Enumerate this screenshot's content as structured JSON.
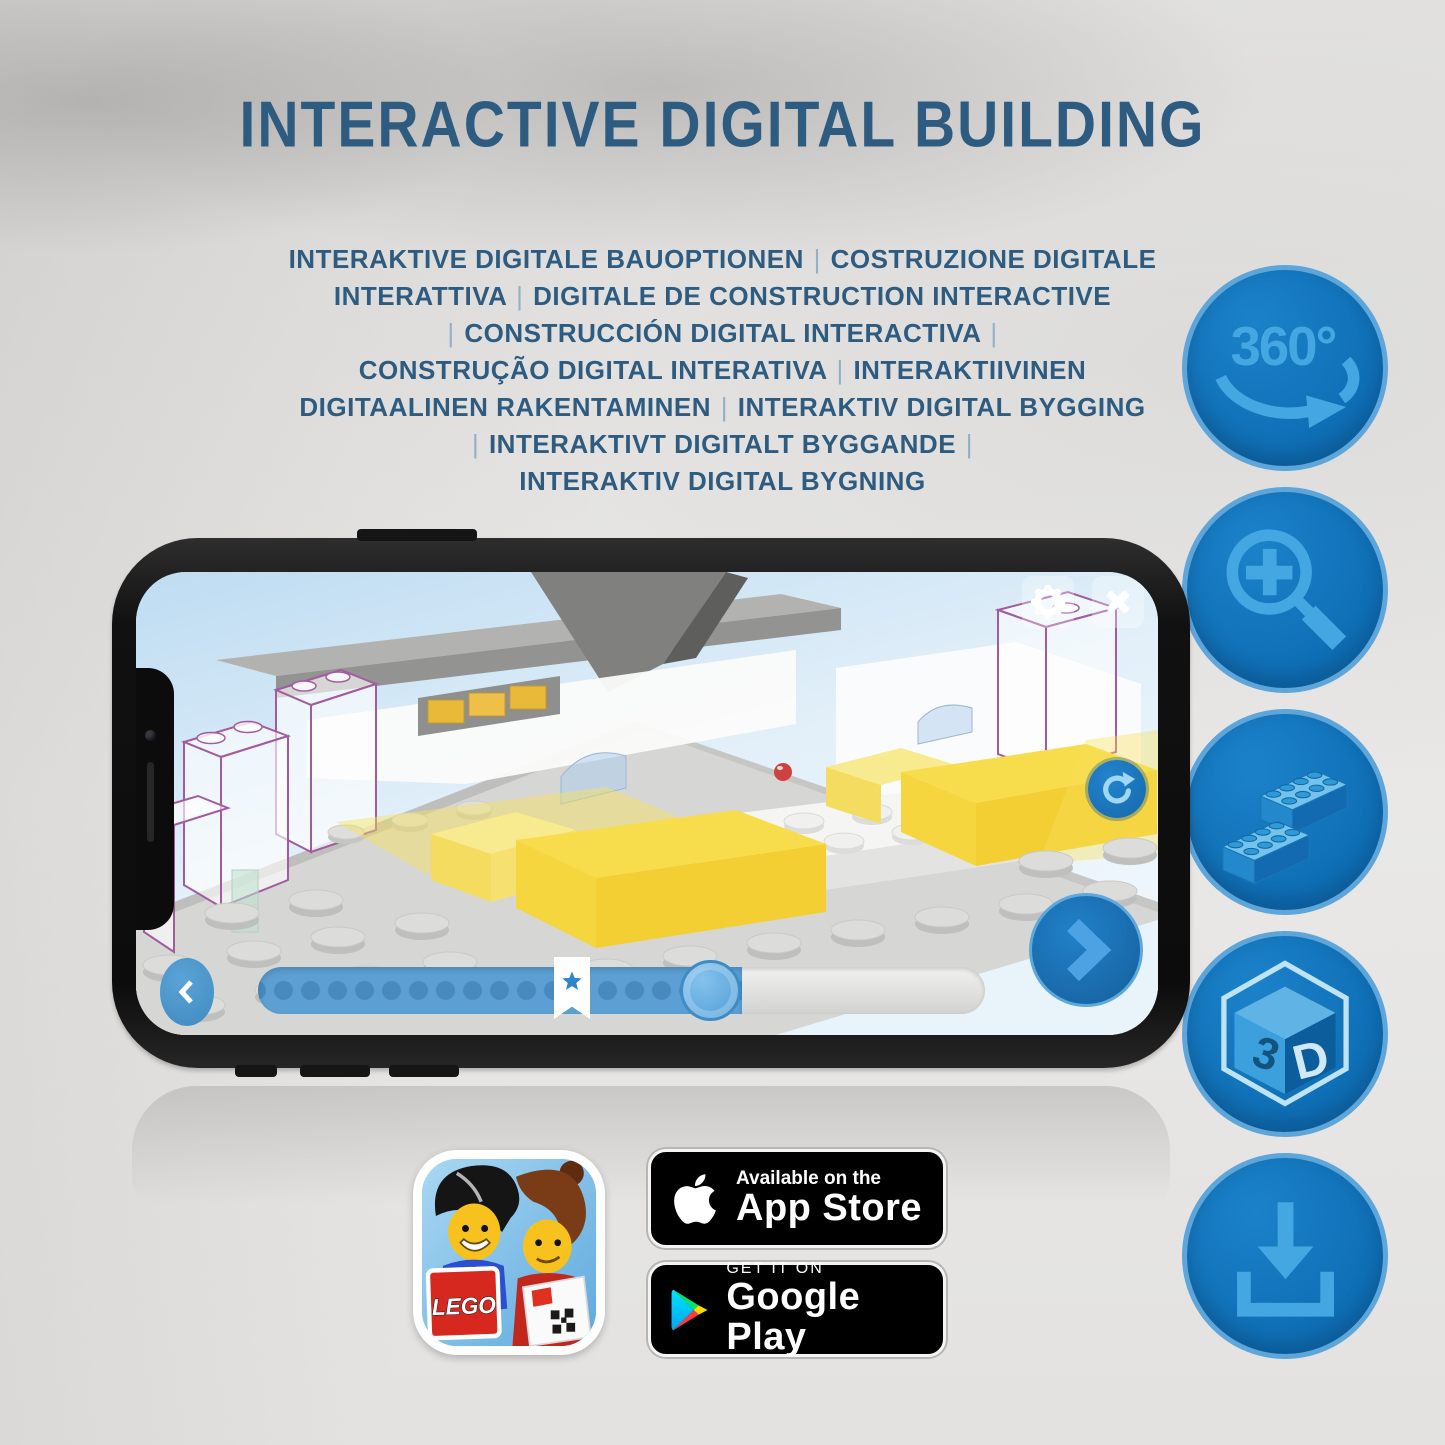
{
  "title": "INTERACTIVE DIGITAL BUILDING",
  "subtitle_lines": [
    "INTERAKTIVE DIGITALE BAUOPTIONEN | COSTRUZIONE DIGITALE",
    "INTERATTIVA | DIGITALE DE CONSTRUCTION INTERACTIVE",
    "| CONSTRUCCIÓN DIGITAL INTERACTIVA |",
    "CONSTRUÇÃO DIGITAL INTERATIVA | INTERAKTIIVINEN",
    "DIGITAALINEN RAKENTAMINEN | INTERAKTIV DIGITAL BYGGING",
    "| INTERAKTIVT DIGITALT BYGGANDE |",
    "INTERAKTIV DIGITAL BYGNING"
  ],
  "features": {
    "rotation_label": "360°",
    "cube_left": "3",
    "cube_right": "D"
  },
  "badges": {
    "app_store": {
      "line1": "Available on the",
      "line2": "App Store"
    },
    "google_play": {
      "line1": "GET IT ON",
      "line2": "Google Play"
    },
    "lego_logo": "LEGO"
  },
  "colors": {
    "heading_blue": "#2e5c81",
    "feature_circle_blue": "#1174bb",
    "feature_circle_border": "#5ea6da",
    "feature_glyph_blue": "#45a7e1",
    "app_slider_fill": "#5c9fd2",
    "brick_yellow": "#f6d83d",
    "ghost_outline_purple": "#a25ba0",
    "badge_black": "#000000"
  }
}
